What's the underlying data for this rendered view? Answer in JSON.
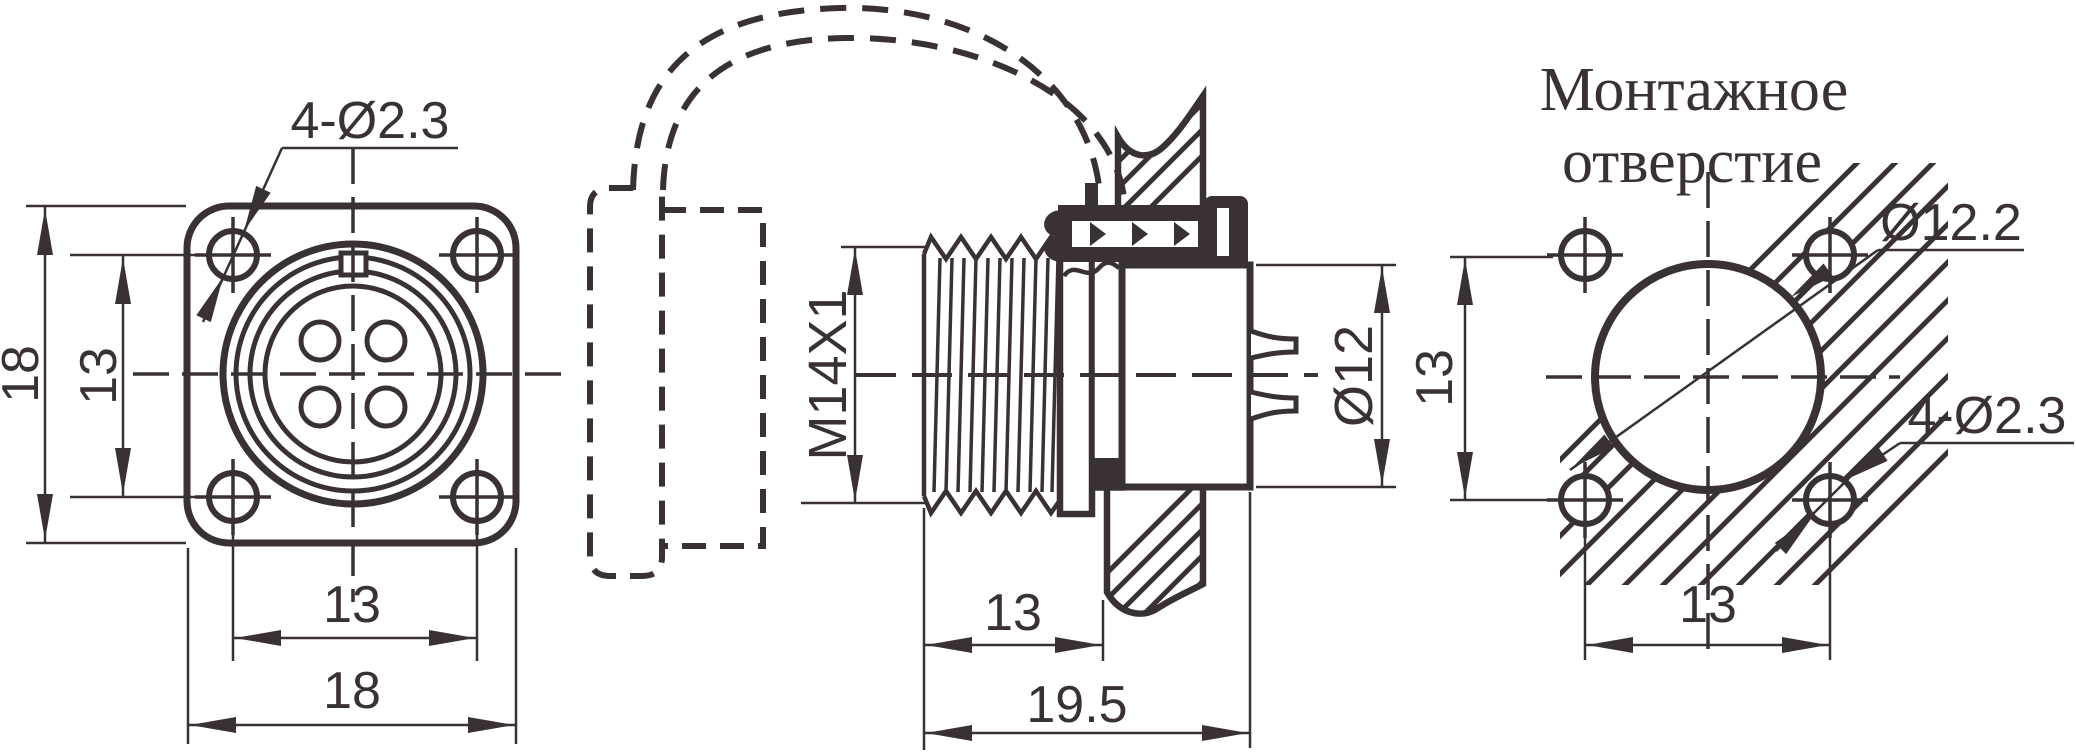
{
  "drawing": {
    "type": "engineering-connector-drawing",
    "colors": {
      "ink": "#3a3133",
      "background": "#ffffff"
    },
    "front_view": {
      "name": "front flange view",
      "hole_callout": "4-Ø2.3",
      "dim_height_outer": "18",
      "dim_height_inner": "13",
      "dim_width_inner": "13",
      "dim_width_outer": "18",
      "pin_count": 4
    },
    "side_view": {
      "name": "side section view",
      "thread_label": "M14X1",
      "dim_thread_length": "13",
      "dim_total_length": "19.5",
      "dim_body_diameter": "Ø12"
    },
    "mounting_view": {
      "name": "mounting hole view",
      "title_line1": "Монтажное",
      "title_line2": "отверстие",
      "dim_hole_diameter": "Ø12.2",
      "holes_callout": "4-Ø2.3",
      "dim_vertical": "13",
      "dim_horizontal": "13"
    }
  }
}
